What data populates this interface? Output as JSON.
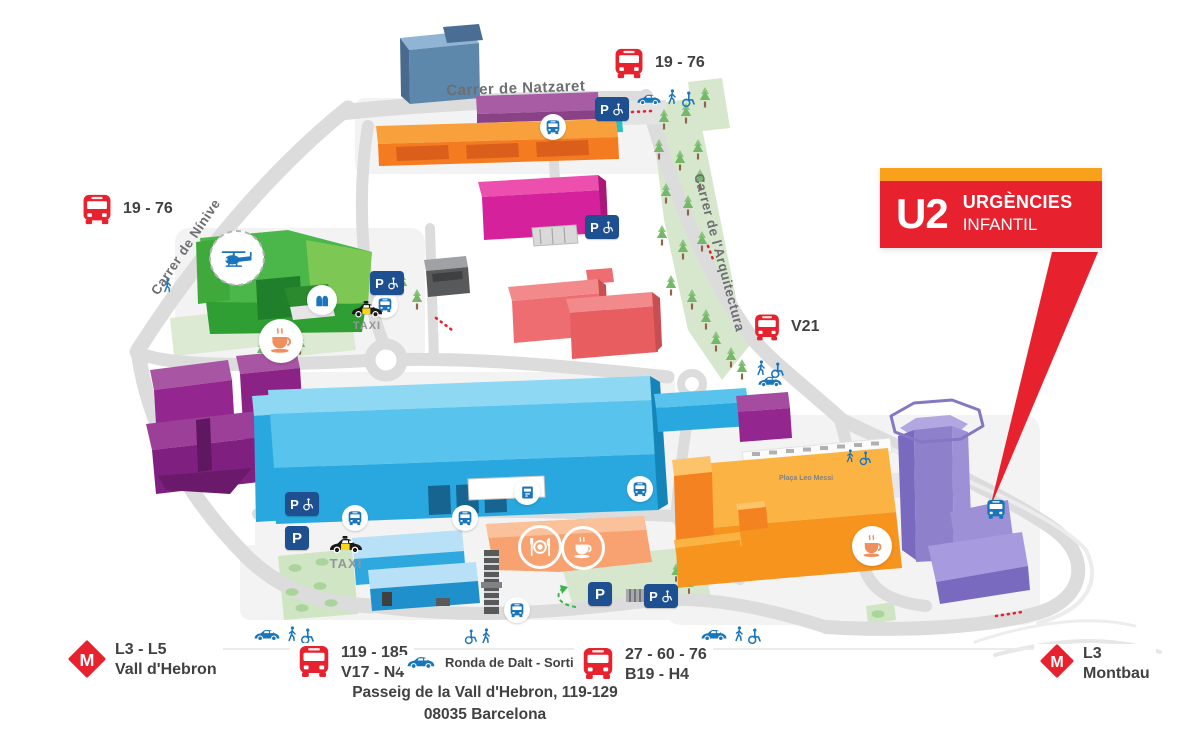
{
  "callout": {
    "code": "U2",
    "line1": "URGÈNCIES",
    "line2": "INFANTIL"
  },
  "streets": {
    "natzaret": "Carrer de Natzaret",
    "ninive": "Carrer de Nínive",
    "arquitectura": "Carrer de l'Arquitectura",
    "placa_leo_messi": "Plaça Leo Messi"
  },
  "bus_stops": {
    "north": "19 - 76",
    "west": "19 - 76",
    "east": "V21"
  },
  "legend": {
    "metro_left": {
      "lines": "L3 - L5",
      "station": "Vall d'Hebron"
    },
    "bus_left": {
      "row1": "119 - 185",
      "row2": "V17 - N4"
    },
    "ronda": "Ronda de Dalt - Sortida 5",
    "bus_right": {
      "row1": "27 - 60 - 76",
      "row2": "B19 - H4"
    },
    "metro_right": {
      "lines": "L3",
      "station": "Montbau"
    }
  },
  "address": {
    "line1": "Passeig de la Vall d'Hebron, 119-129",
    "line2": "08035 Barcelona"
  },
  "labels": {
    "taxi": "TAXI",
    "parking": "P",
    "metro": "M"
  },
  "colors": {
    "red": "#e8212e",
    "orange": "#f9a11b",
    "transit_blue": "#1b75bb",
    "parking_blue": "#1d4f91"
  }
}
